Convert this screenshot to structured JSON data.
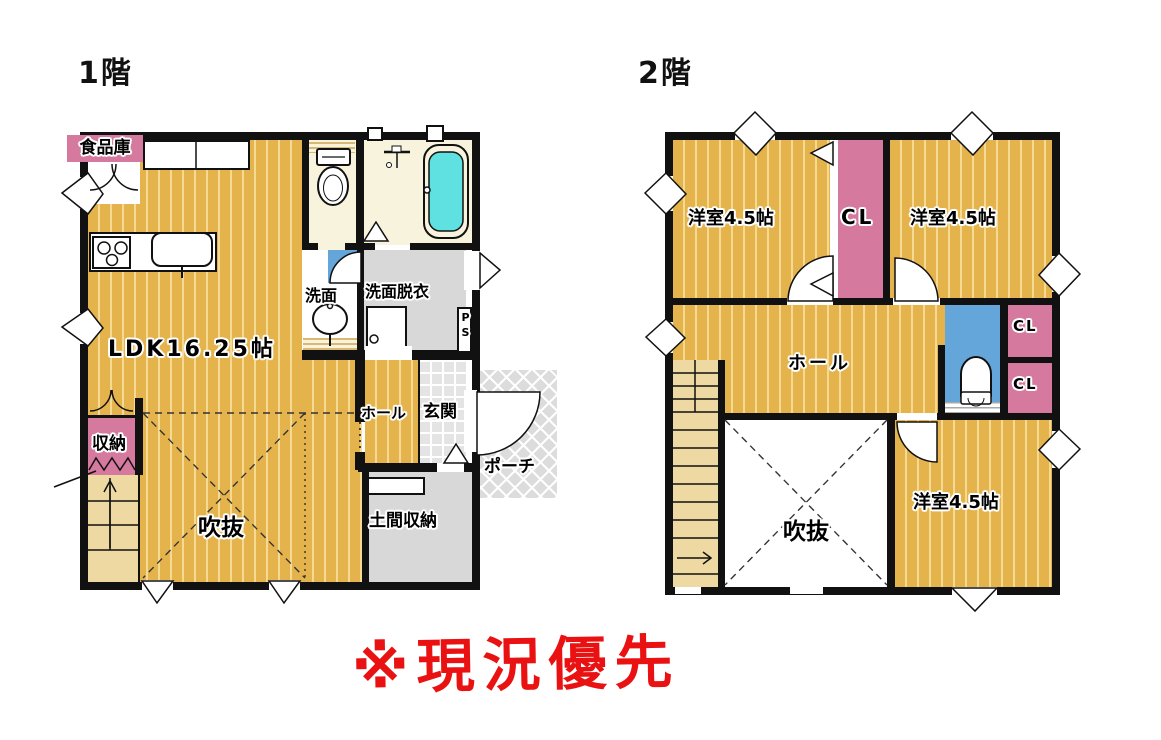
{
  "titles": {
    "floor1": "1階",
    "floor2": "2階"
  },
  "note": {
    "text": "※現況優先",
    "color": "#e91111"
  },
  "floor1": {
    "pantry": "食品庫",
    "ldk": "LDK16.25帖",
    "washroom": "洗面",
    "dressing": "洗面脱衣",
    "pipe_space": "PS",
    "hall": "ホール",
    "entrance": "玄関",
    "porch": "ポーチ",
    "doma_storage": "土間収納",
    "closet": "収納",
    "void": "吹抜"
  },
  "floor2": {
    "room_nw": "洋室4.5帖",
    "room_ne": "洋室4.5帖",
    "room_se": "洋室4.5帖",
    "closet_center": "CL",
    "closet_upper": "CL",
    "closet_lower": "CL",
    "hall": "ホール",
    "void": "吹抜"
  },
  "colors": {
    "floor_yellow": "#e5b34c",
    "floor_stripe": "#f4da93",
    "closet_pink": "#d6799e",
    "toilet_blue": "#64a5da",
    "bath_cream": "#f8f3dc",
    "tub_cyan": "#5fe1e1",
    "room_gray": "#d8d8d8",
    "stairs_tan": "#edd9a1",
    "wall": "#111111",
    "note_red": "#e91111"
  }
}
